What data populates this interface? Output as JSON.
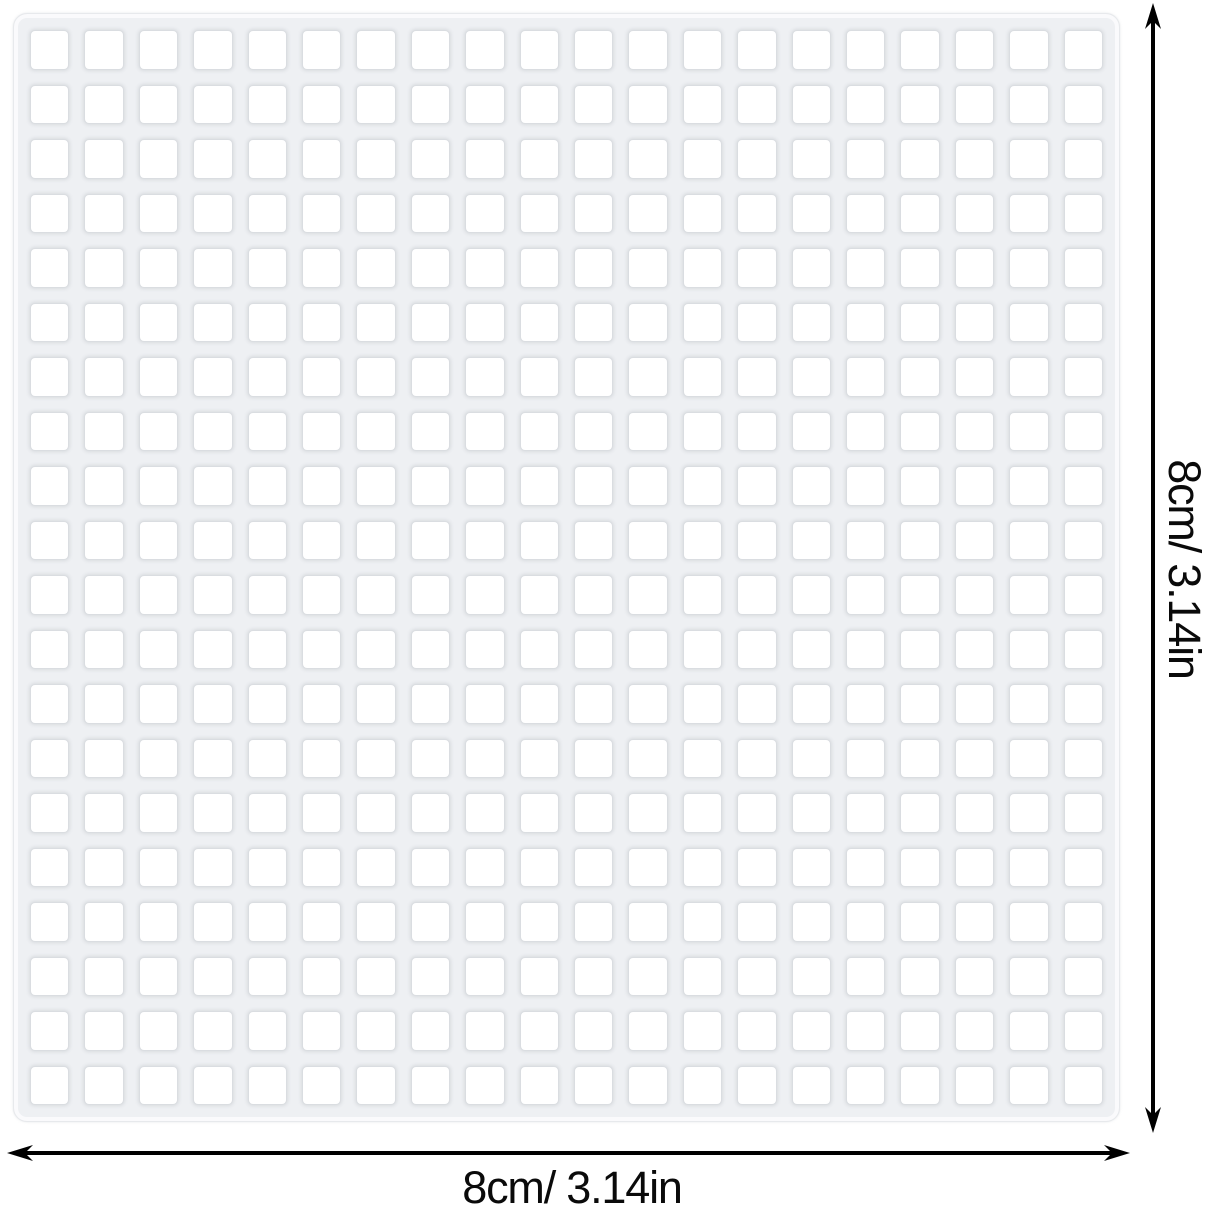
{
  "figure": {
    "description": "white plastic canvas mesh sheet with dimension arrows",
    "width_label": "8cm/ 3.14in",
    "height_label": "8cm/ 3.14in"
  },
  "mesh": {
    "rows": 20,
    "cols": 20
  },
  "colors": {
    "background": "#ffffff",
    "mesh_bar": "#eef0f3",
    "mesh_hole": "#ffffff",
    "hole_edge": "#dadde1",
    "arrow": "#000000",
    "text": "#0a0a0a"
  }
}
